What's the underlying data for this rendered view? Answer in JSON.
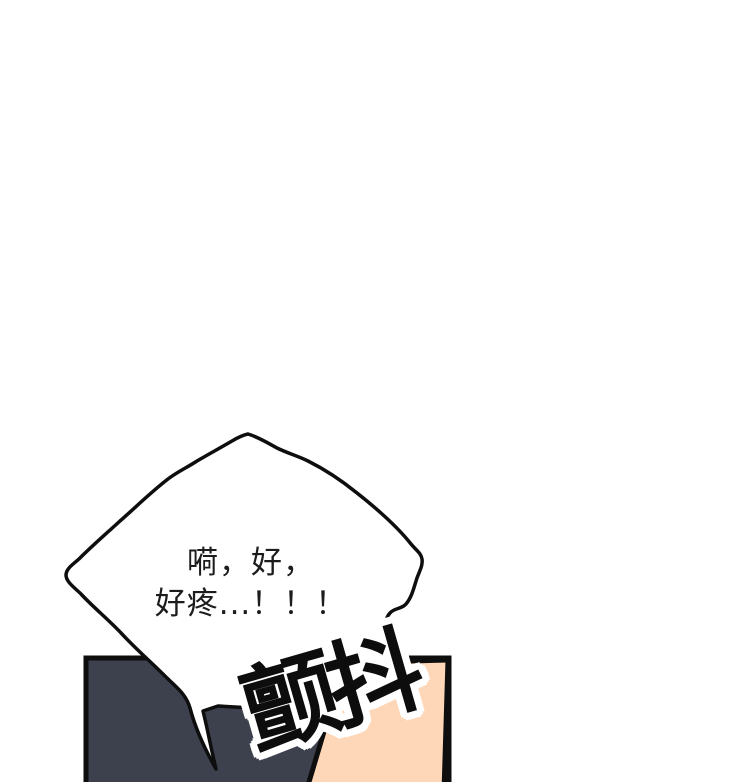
{
  "panel": {
    "background_color": "#ffffff",
    "speech_bubble": {
      "lines": [
        "嗬，好，",
        "好疼...！！！"
      ],
      "fill_color": "#ffffff",
      "outline_color": "#0e0e0e",
      "text_color": "#1c1c1c"
    },
    "sfx": {
      "text": "颤抖",
      "text_color": "#0d0d0d",
      "halo_color": "#ffffff",
      "rotation_deg": -16
    },
    "shapes": {
      "dark_shape_color": "#3d414e",
      "skin_shape_color": "#fdd7b7",
      "outline_color": "#0e0e0e"
    }
  }
}
